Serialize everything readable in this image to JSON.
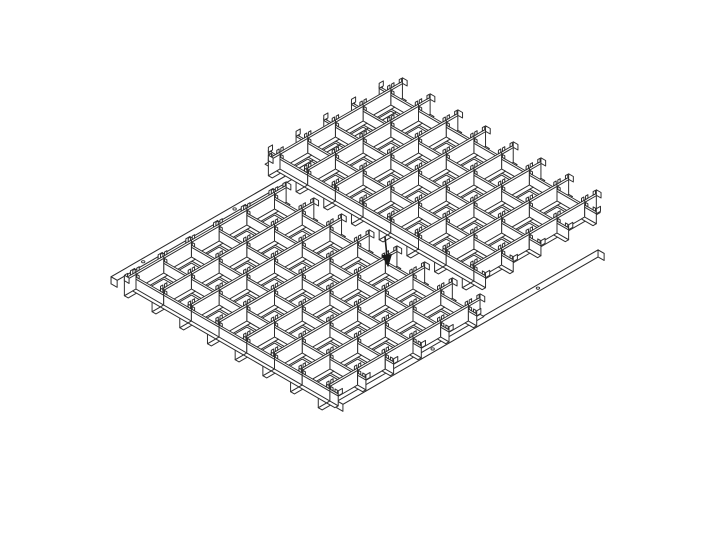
{
  "diagram": {
    "kind": "isometric-assembly-line-drawing",
    "subject": "egg-crate grid modules with edge rails and assembly arrow",
    "background_color": "#ffffff",
    "line_color": "#2e2e2e",
    "fill_color": "#ffffff",
    "arrow_color": "#1a1a1a",
    "canvas": {
      "width": 711,
      "height": 534
    }
  },
  "iso": {
    "ax": 27.7,
    "ay": -16.0,
    "bx": 27.7,
    "by": 16.0
  },
  "profiles": {
    "channel_height": 20,
    "blade_height": 15,
    "floor_z": 3,
    "rhombus_z": 2,
    "rhombus_inset": 0.16,
    "hem_drop": 2.4,
    "tab_height": 3.5,
    "tab_width": 0.085,
    "tab_gap": 0.03,
    "hook_width": 0.17,
    "channel_flange": 0.14,
    "blade_flange": 0.12,
    "channel_prot": 0.42
  },
  "grids": [
    {
      "name": "upper-grid-module",
      "origin": [
        280,
        172
      ],
      "cells_a": 4,
      "cells_b": 7,
      "nw_prot": 0.42,
      "se_prot": 0.42
    },
    {
      "name": "lower-grid-module",
      "origin": [
        136,
        292
      ],
      "cells_a": 5,
      "cells_b": 7,
      "nw_prot": 0.2,
      "se_prot": 0.3
    }
  ],
  "rails": [
    {
      "name": "attached-edge-rail",
      "grid_index": 1,
      "b": -0.55,
      "a0": -0.35,
      "a1": 10.1,
      "flange_w": 0.22,
      "z_top": 12,
      "z_bot": 5,
      "holes": [
        0.7,
        4.0,
        7.3
      ]
    },
    {
      "name": "loose-edge-rail",
      "grid_index": 1,
      "b": 7.4,
      "a0": -0.15,
      "a1": 9.28,
      "flange_w": 0.22,
      "z_top": 12,
      "z_bot": 5,
      "holes": [
        3.2,
        7.0
      ]
    }
  ],
  "hole_size": {
    "rx": 1.7,
    "ry": 1.1
  },
  "arrow": {
    "tail": [
      385,
      237
    ],
    "tip": [
      388,
      266
    ],
    "head_half_width": 4.5,
    "head_length": 11
  },
  "draw_order": [
    "rail:0",
    "grid:0",
    "rail:1",
    "grid:1",
    "arrow"
  ]
}
